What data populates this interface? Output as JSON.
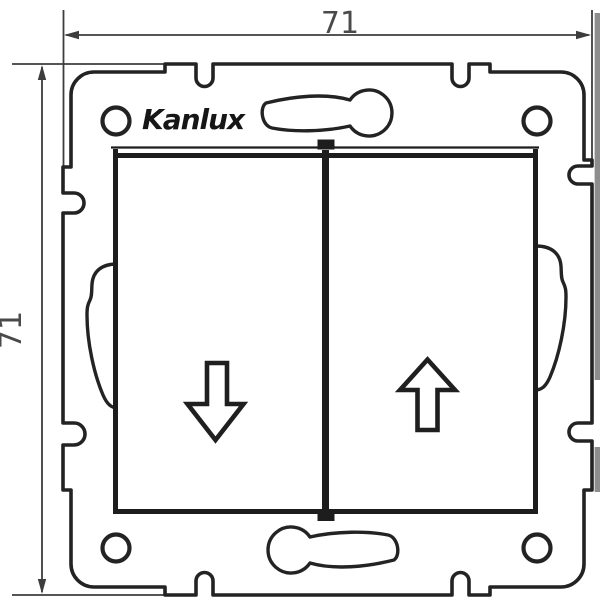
{
  "drawing": {
    "brand": {
      "logo_text": "Kanlux"
    },
    "dimensions": {
      "width_label": "71",
      "height_label": "71"
    },
    "symbols": {
      "left_button_icon": "arrow-down",
      "right_button_icon": "arrow-up"
    },
    "colors": {
      "background": "#ffffff",
      "line": "#232323",
      "dimension": "#3d3d3d",
      "label": "#4a4a4a",
      "artifact_strip": "#8d8d8d"
    }
  }
}
